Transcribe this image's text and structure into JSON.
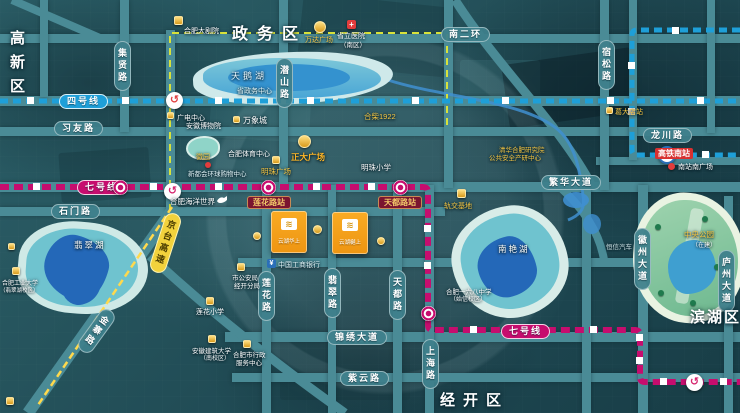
{
  "colors": {
    "line4": "#1E9FD8",
    "line7": "#C60D6E",
    "boundary": "#D8E23A",
    "highway_line": "#FFD94D",
    "road": "#4A8B96",
    "parcel": "#F5A01B",
    "gold_poi": "#F5C542"
  },
  "districts": {
    "gaoxin": "高新区",
    "zhengwu": "政务区",
    "binhu": "滨湖区",
    "jingkai": "经开区"
  },
  "metro": {
    "line4_badge": "四号线",
    "line7_badge": "七号线",
    "line7_badge2": "七号线",
    "loop_glyph": "↺",
    "rail_glyph": "工"
  },
  "roads": {
    "jixian": "集贤路",
    "xiyou": "习友路",
    "qianshan": "潜山路",
    "nanerhuan": "南二环",
    "susong": "宿松路",
    "longchuan": "龙川路",
    "fanhua": "繁华大道",
    "shimen": "石门路",
    "jinzhai": "金寨路",
    "jingtai": "京台高速",
    "lianhua": "莲花路",
    "feicui": "翡翠路",
    "tiandu": "天都路",
    "shanghai": "上海路",
    "jinxiu": "锦绣大道",
    "ziyun": "紫云路",
    "huizhou": "徽州大道",
    "luzhou": "庐州大道"
  },
  "stations": {
    "lianhua": "莲花路站",
    "tiandu": "天都路站",
    "gedadian": "葛大店站"
  },
  "lakes": {
    "tianehu": "天鹅湖",
    "feicuihu": "翡翠湖",
    "nanyanhu": "南艳湖",
    "huiyuan": "徽园"
  },
  "park": {
    "name": "中央公园",
    "status": "（在建）"
  },
  "pois": {
    "theatre": "合肥大剧院",
    "wanda": "万达广场",
    "hospital_l1": "省立医院",
    "hospital_l2": "（南区）",
    "gov": "省政务中心",
    "radio": "广电中心",
    "museum": "安徽博物院",
    "mixc": "万象城",
    "hechai": "合柴1922",
    "sports": "合肥体育中心",
    "zhengda": "正大广场",
    "mingzhu_plaza": "明珠广场",
    "xinduhui": "新都会环球购物中心",
    "mingzhu_school": "明珠小学",
    "ocean": "合肥海洋世界",
    "tsinghua_l1": "清华合肥研究院",
    "tsinghua_l2": "公共安全产研中心",
    "rail_base": "轨交基地",
    "school168_l1": "合肥一六八中学",
    "school168_l2": "（始信校区）",
    "police_l1": "市公安局",
    "police_l2": "经开分局",
    "lianhua_school": "莲花小学",
    "univ_l1": "安徽建筑大学",
    "univ_l2": "（南校区）",
    "admin_l1": "合肥市行政",
    "admin_l2": "服务中心",
    "hfut_l1": "合肥工业大学",
    "hfut_l2": "（翡翠湖校区）",
    "bank": "中国工商银行",
    "hsr": "高铁南站",
    "south_square": "南站南广场",
    "auto": "恒信汽车",
    "bank_glyph": "¥",
    "cross_glyph": "+"
  },
  "parcels": {
    "a": "云湖华上",
    "b": "云湖樾上",
    "logo_glyph": "≋"
  }
}
